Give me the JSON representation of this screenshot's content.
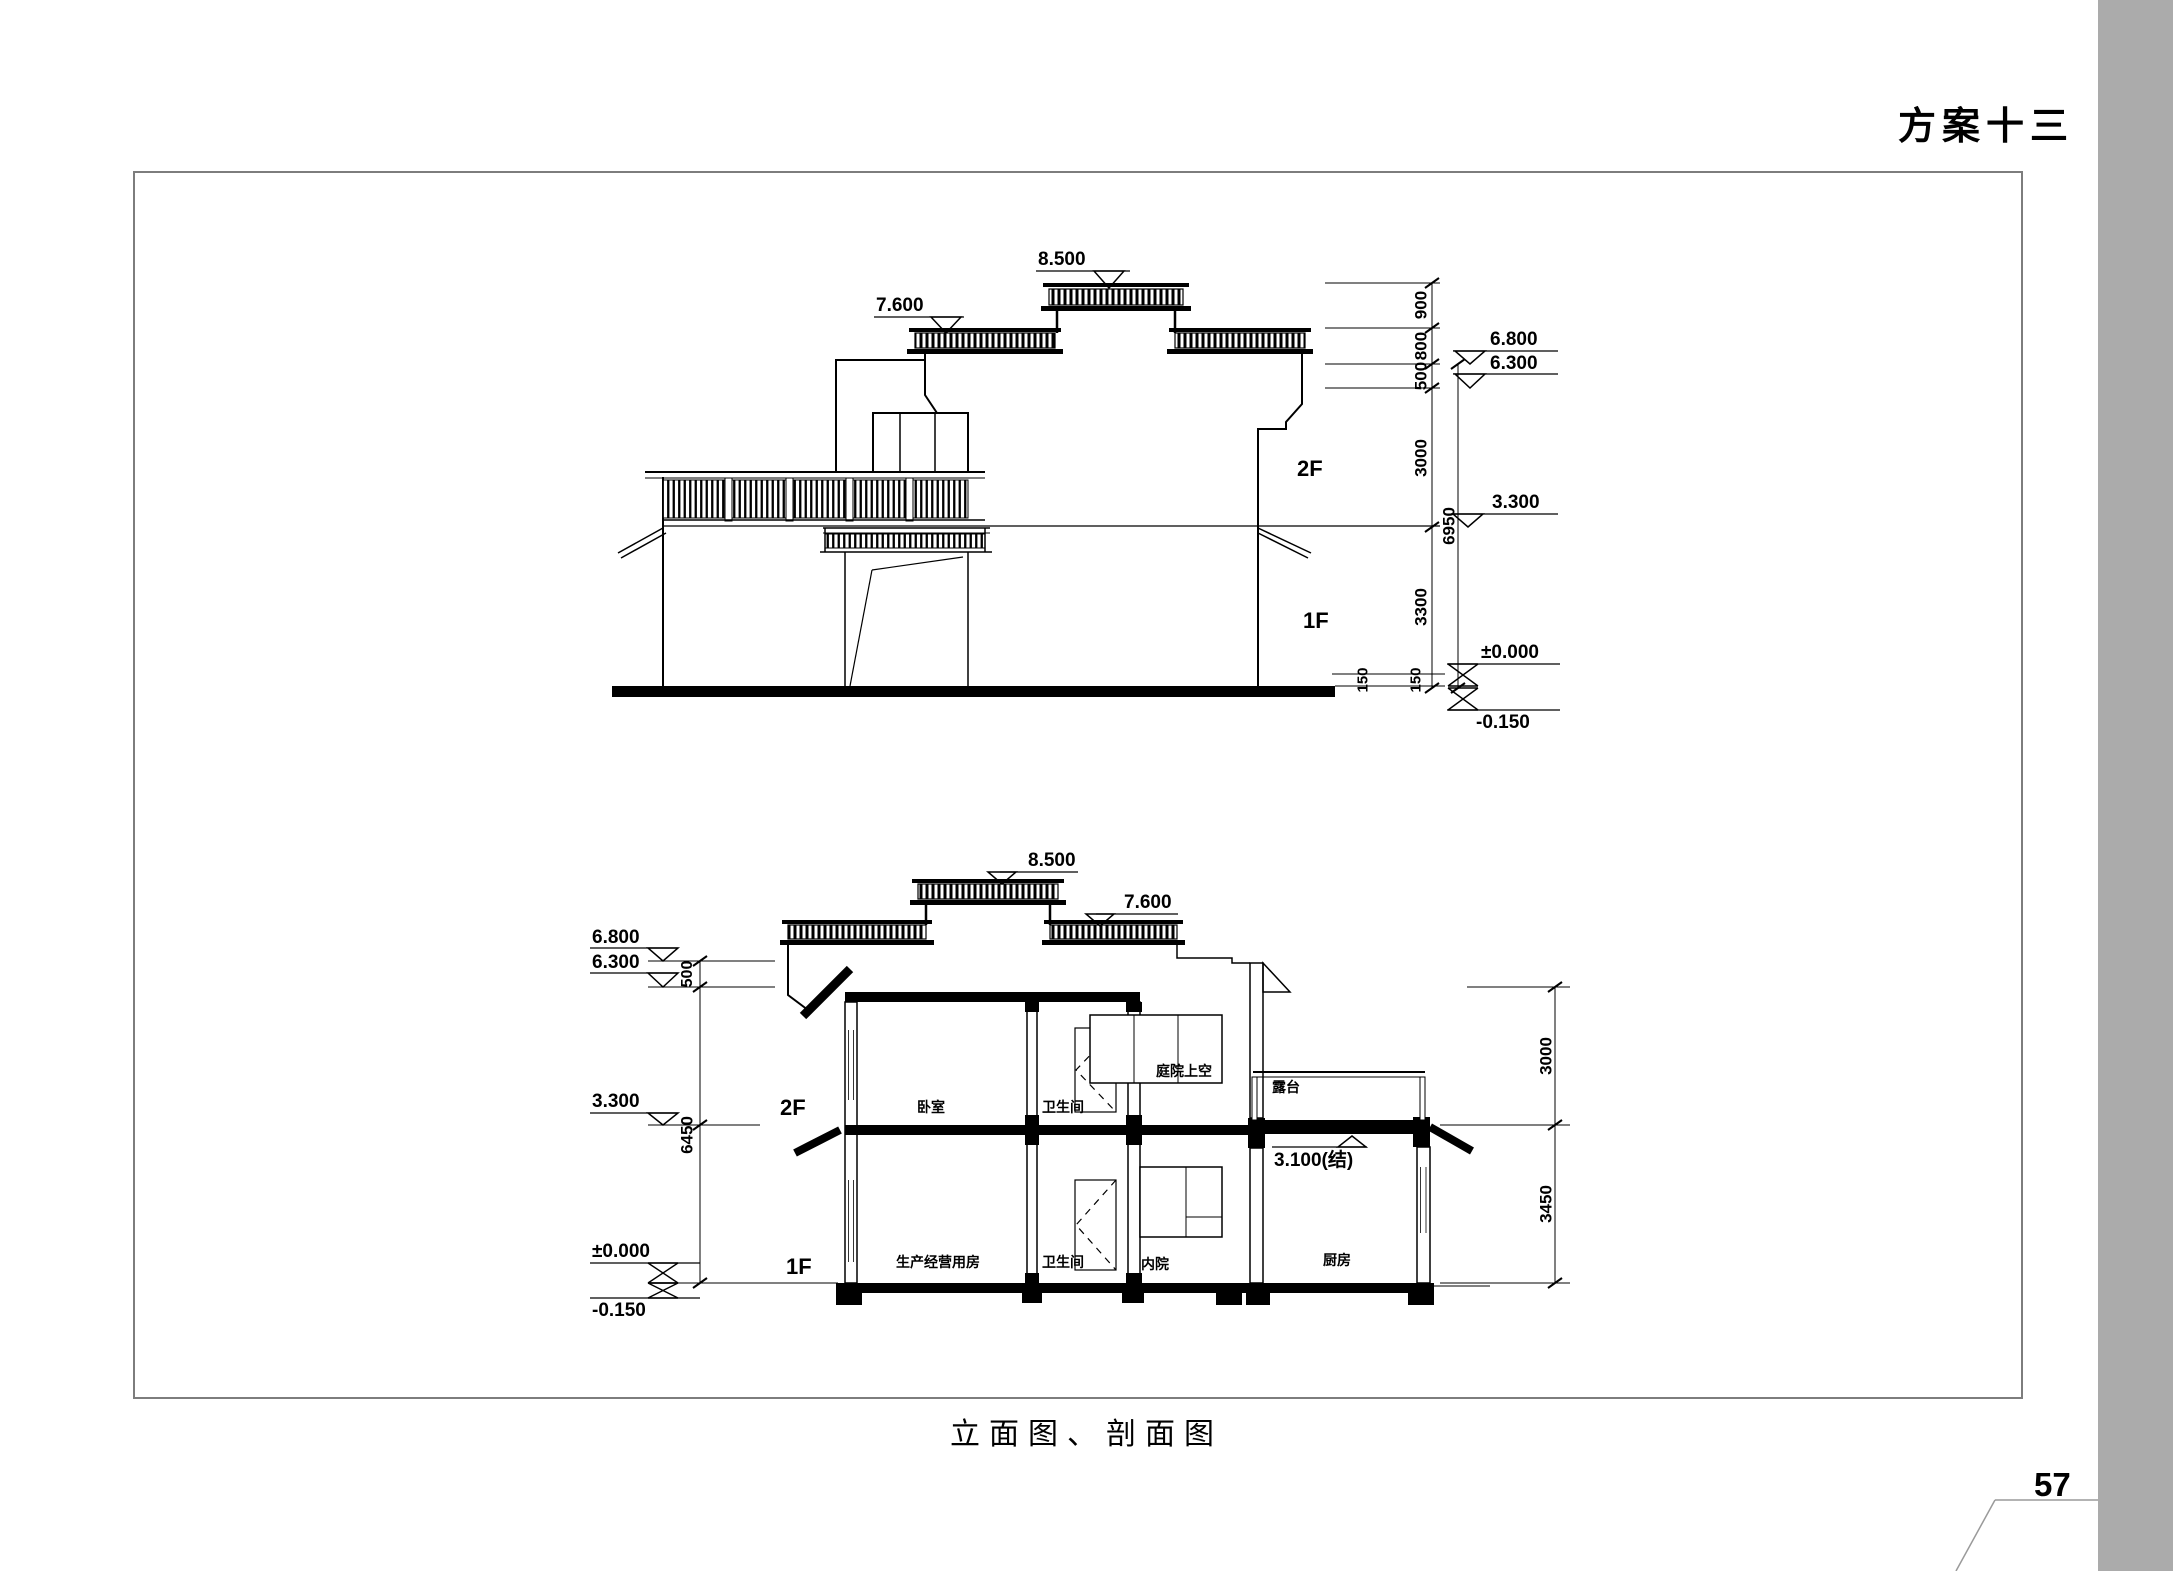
{
  "page": {
    "heading": "方案十三",
    "caption": "立面图、剖面图",
    "page_number": "57"
  },
  "elevation": {
    "levels": {
      "roof_top": "8.500",
      "roof_side": "7.600",
      "eave_high": "6.800",
      "eave_low": "6.300",
      "floor2": "3.300",
      "ground": "±0.000",
      "site": "-0.150"
    },
    "floors": {
      "f2": "2F",
      "f1": "1F"
    },
    "dims": {
      "d900": "900",
      "d800": "800",
      "d500": "500",
      "d3000": "3000",
      "d3300": "3300",
      "d6950": "6950",
      "d150a": "150",
      "d150b": "150"
    }
  },
  "section": {
    "levels": {
      "roof_top": "8.500",
      "roof_side": "7.600",
      "eave_high": "6.800",
      "eave_low": "6.300",
      "floor2": "3.300",
      "terrace_struct": "3.100(结)",
      "ground": "±0.000",
      "site": "-0.150"
    },
    "floors": {
      "f2": "2F",
      "f1": "1F"
    },
    "dims": {
      "d500": "500",
      "d6450": "6450",
      "d3000": "3000",
      "d3450": "3450"
    },
    "rooms": {
      "bedroom": "卧室",
      "bathroom_2f": "卫生间",
      "courtyard_above": "庭院上空",
      "terrace": "露台",
      "production_room": "生产经营用房",
      "bathroom_1f": "卫生间",
      "inner_courtyard": "内院",
      "kitchen": "厨房"
    }
  }
}
